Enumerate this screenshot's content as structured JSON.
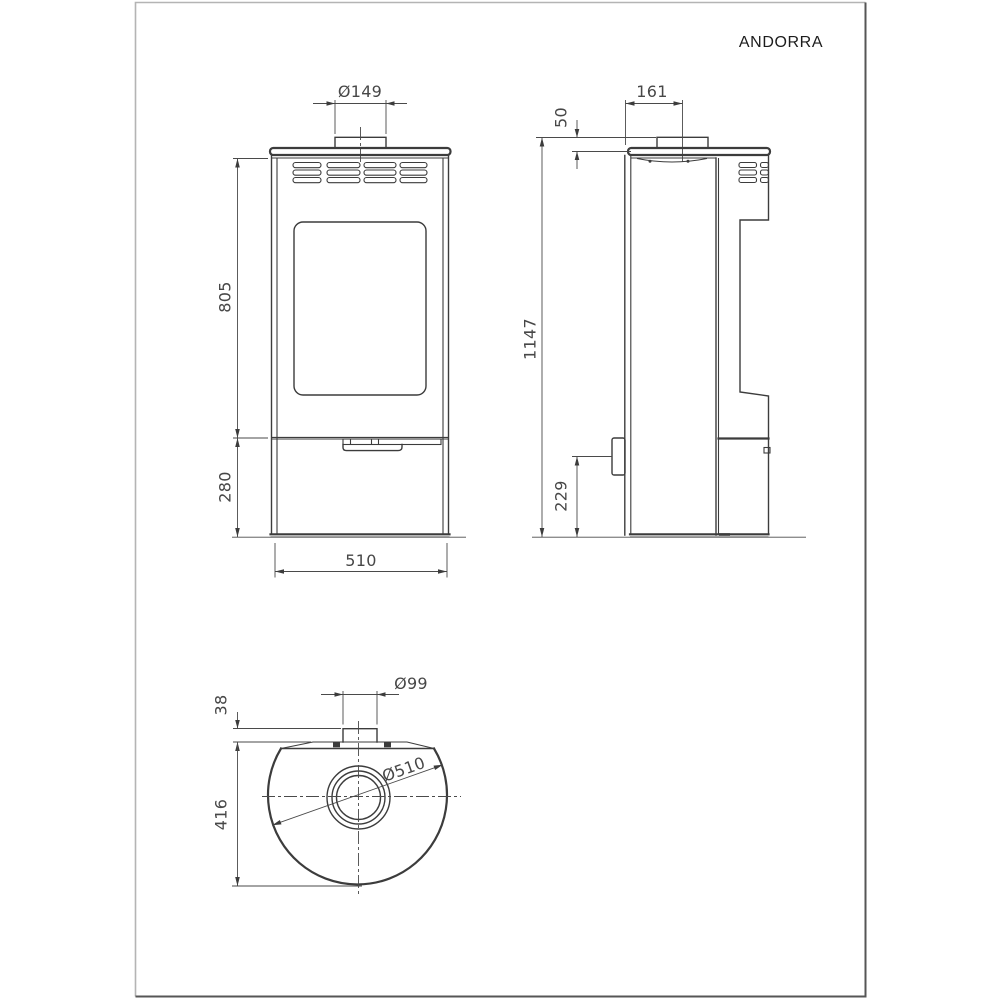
{
  "sheet": {
    "title": "ANDORRA",
    "kind": "technical dimensional drawing of a wood stove"
  },
  "views": {
    "front": {
      "name": "front-view",
      "dimensions": [
        {
          "id": "flue_collar_diameter",
          "label": "Ø149"
        },
        {
          "id": "upper_body_height",
          "label": "805"
        },
        {
          "id": "base_section_height",
          "label": "280"
        },
        {
          "id": "overall_width",
          "label": "510"
        }
      ]
    },
    "side": {
      "name": "side-view",
      "dimensions": [
        {
          "id": "flue_center_offset",
          "label": "161"
        },
        {
          "id": "collar_above_top",
          "label": "50"
        },
        {
          "id": "overall_height",
          "label": "1147"
        },
        {
          "id": "handle_height",
          "label": "229"
        }
      ]
    },
    "top": {
      "name": "top-view",
      "dimensions": [
        {
          "id": "rear_outlet_diameter",
          "label": "Ø99"
        },
        {
          "id": "rear_stub_offset",
          "label": "38"
        },
        {
          "id": "body_diameter",
          "label": "Ø510"
        },
        {
          "id": "overall_depth",
          "label": "416"
        }
      ]
    }
  },
  "colors": {
    "line": "#3c3c3c",
    "dim_text": "#474747",
    "sheet_border_light": "#b4b4b4",
    "sheet_border_dark": "#565656",
    "background": "#ffffff"
  }
}
